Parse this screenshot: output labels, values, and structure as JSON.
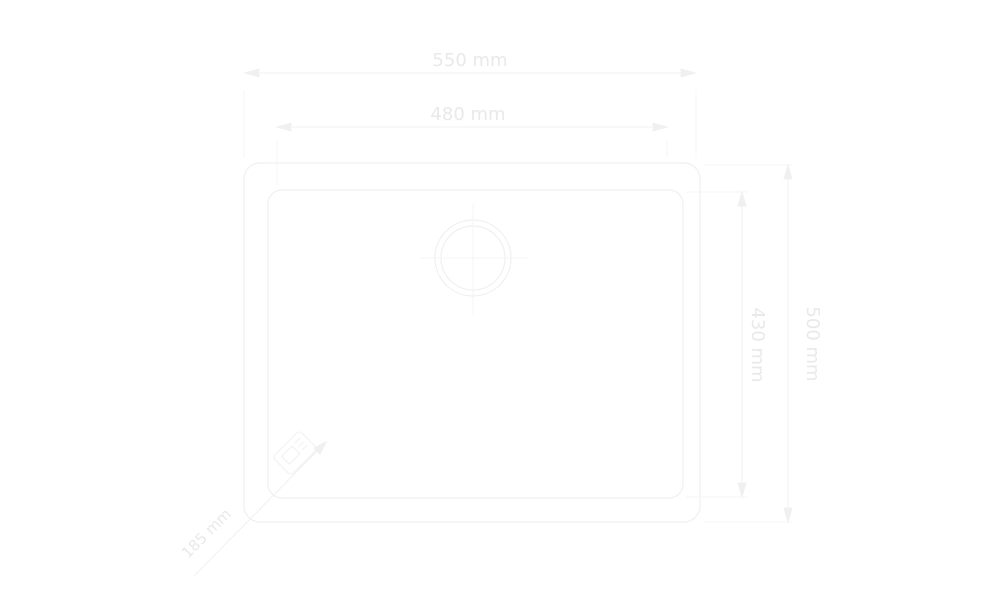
{
  "drawing": {
    "type": "technical dimension drawing",
    "subject": "sink top view with drain and dimension lines",
    "background_color": "#ffffff",
    "line_color": "#f0f0f0",
    "text_color": "#e9e9e9",
    "dimensions": {
      "outer_width": "550 mm",
      "inner_width": "480 mm",
      "inner_depth": "430 mm",
      "outer_depth": "500 mm",
      "diagonal_note": "185 mm"
    },
    "icons": [
      "drain-crosshair-icon",
      "corner-stamp-icon",
      "dimension-arrow-icon"
    ]
  }
}
